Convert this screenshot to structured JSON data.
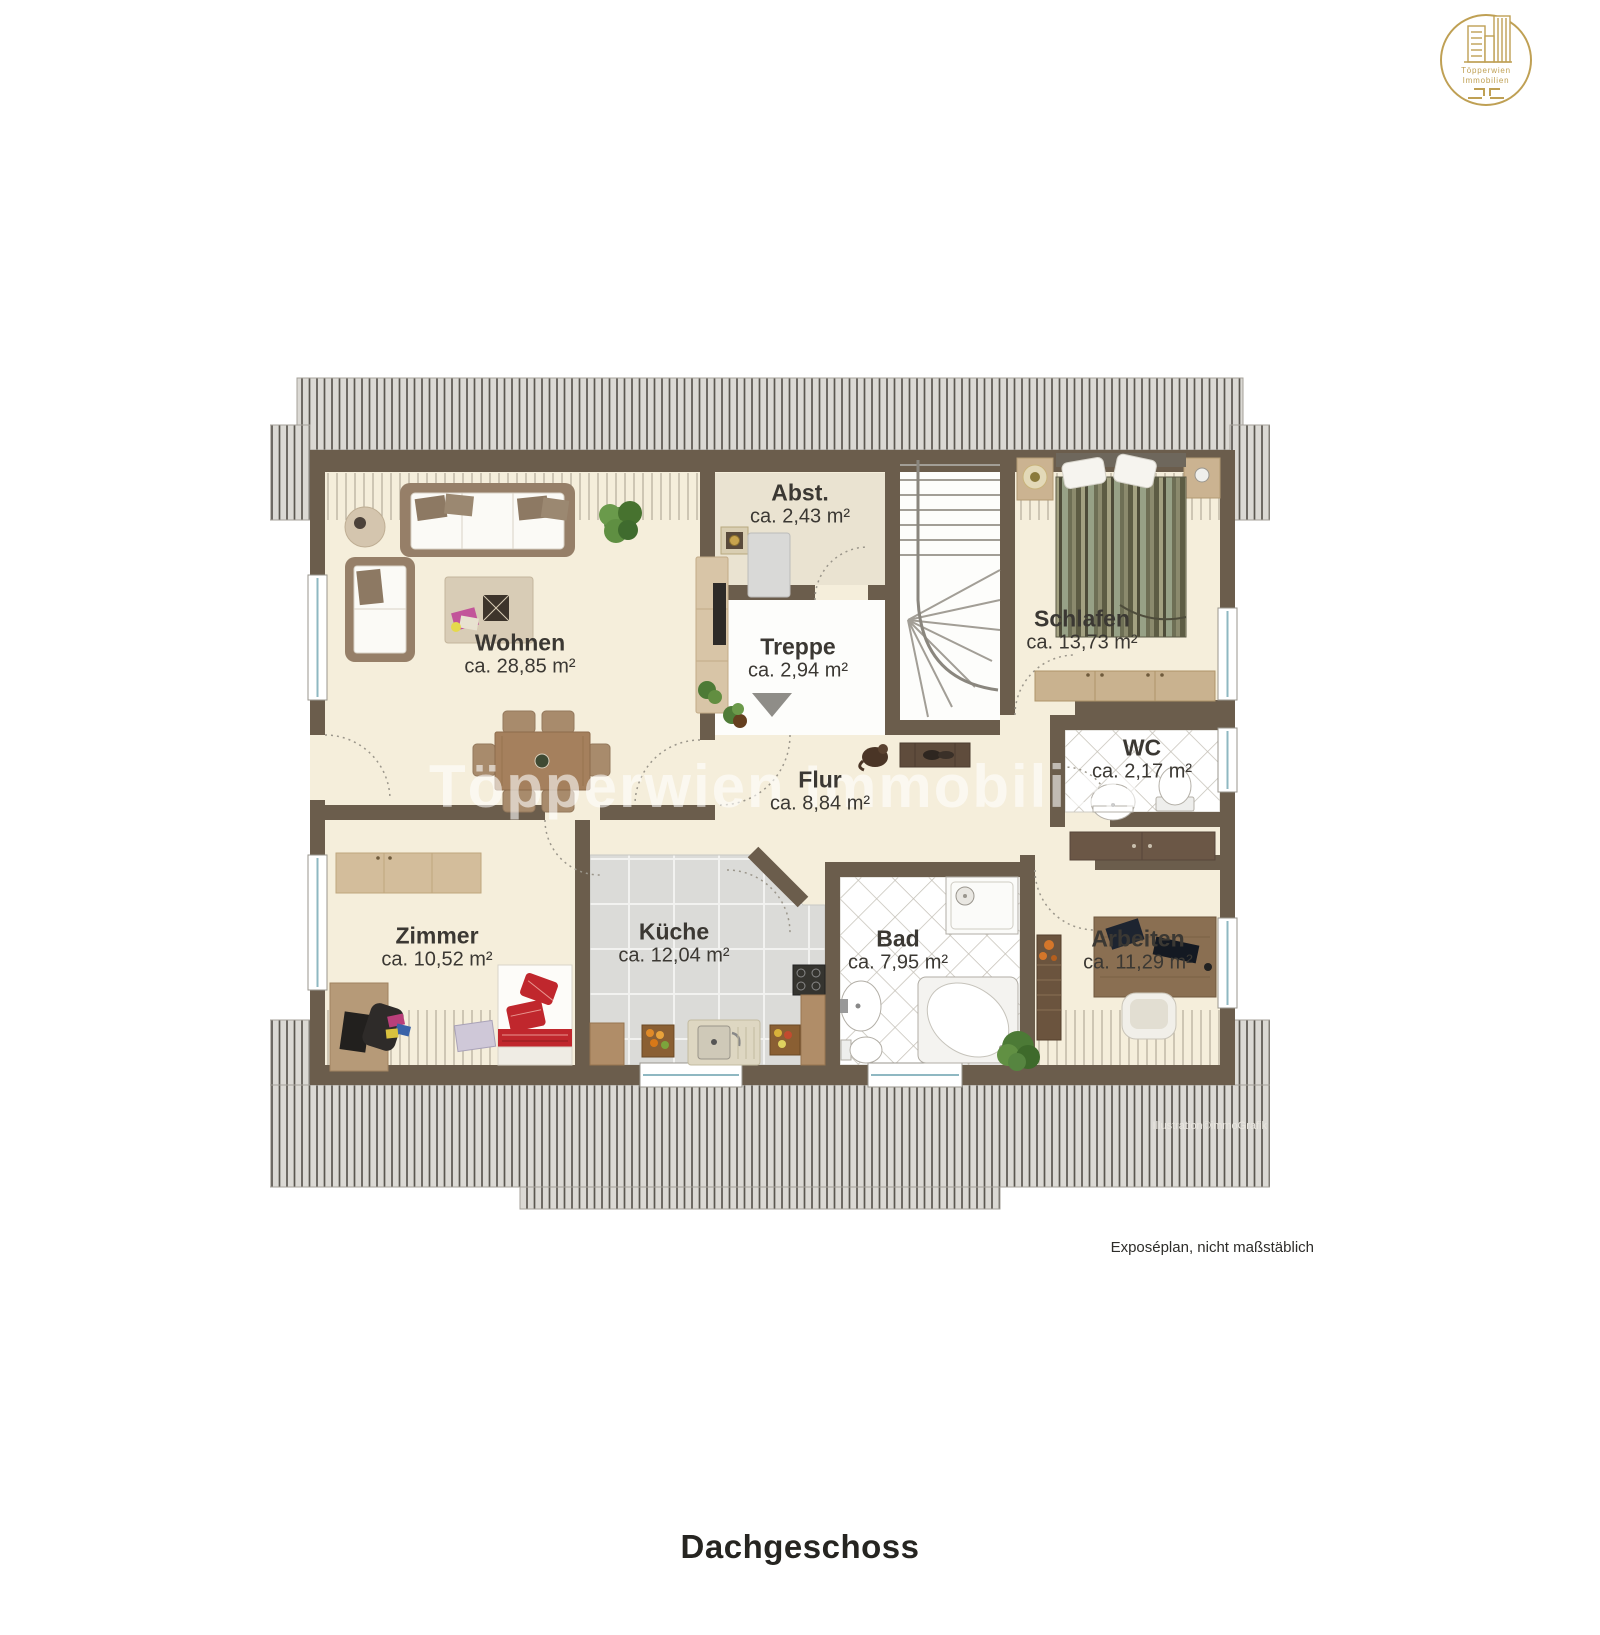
{
  "page": {
    "title": "Dachgeschoss",
    "note": "Exposéplan, nicht maßstäblich",
    "credit": "Illustration©immoGrafik",
    "watermark": "Töpperwien Immobilien"
  },
  "logo": {
    "line1": "Töpperwien",
    "line2": "Immobilien"
  },
  "rooms": [
    {
      "id": "wohnen",
      "name": "Wohnen",
      "area": "ca. 28,85 m²"
    },
    {
      "id": "abst",
      "name": "Abst.",
      "area": "ca. 2,43 m²"
    },
    {
      "id": "treppe",
      "name": "Treppe",
      "area": "ca. 2,94 m²"
    },
    {
      "id": "schlafen",
      "name": "Schlafen",
      "area": "ca. 13,73 m²"
    },
    {
      "id": "wc",
      "name": "WC",
      "area": "ca. 2,17 m²"
    },
    {
      "id": "flur",
      "name": "Flur",
      "area": "ca. 8,84 m²"
    },
    {
      "id": "zimmer",
      "name": "Zimmer",
      "area": "ca. 10,52 m²"
    },
    {
      "id": "kueche",
      "name": "Küche",
      "area": "ca. 12,04 m²"
    },
    {
      "id": "bad",
      "name": "Bad",
      "area": "ca. 7,95 m²"
    },
    {
      "id": "arbeiten",
      "name": "Arbeiten",
      "area": "ca. 11,29 m²"
    }
  ],
  "colors": {
    "wall": "#6b5d4c",
    "floor": "#f5eedb",
    "roof_hatch": "#dbd9d4",
    "kitchen_tile": "#dbdbd8",
    "accent_red": "#c0272d",
    "logo_gold": "#bfa054"
  }
}
